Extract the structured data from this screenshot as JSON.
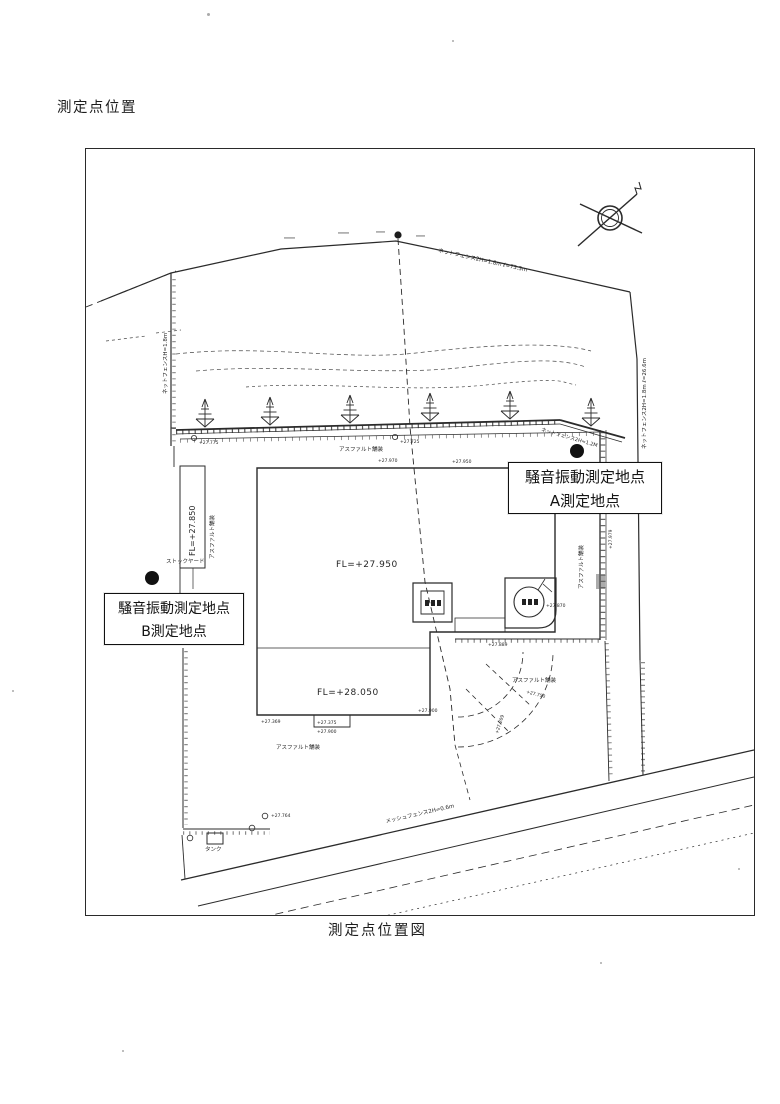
{
  "page": {
    "heading": "測定点位置",
    "caption": "測定点位置図"
  },
  "callouts": {
    "a": {
      "line1": "騒音振動測定地点",
      "line2": "A測定地点"
    },
    "b": {
      "line1": "騒音振動測定地点",
      "line2": "B測定地点"
    }
  },
  "plan": {
    "floor_levels": {
      "main": "FL=+27.950",
      "lower": "FL=+28.050",
      "strip": "FL=+27.850"
    },
    "fences": {
      "top": "ネットフェンス2H=1.8m ℓ=73.3m",
      "middle": "ネットフェンス2H=1.2M",
      "right": "ネットフェンス2H=1.8m ℓ=26.6m",
      "left": "ネットフェンスH=1.8m",
      "road": "メッシュフェンス2H=0.6m"
    },
    "areas": {
      "asphalt": "アスファルト舗装",
      "stockyard": "ストックヤード",
      "tank": "タンク"
    },
    "elevations": [
      "+27.970",
      "+27.950",
      "+27.775",
      "+27.725",
      "+27.889",
      "+27.750",
      "+27.369",
      "+27.375",
      "+27.900",
      "+27.870",
      "+27.979",
      "+27.764",
      "+27.209"
    ]
  },
  "colors": {
    "ink": "#1d1d1d",
    "paper": "#ffffff"
  }
}
